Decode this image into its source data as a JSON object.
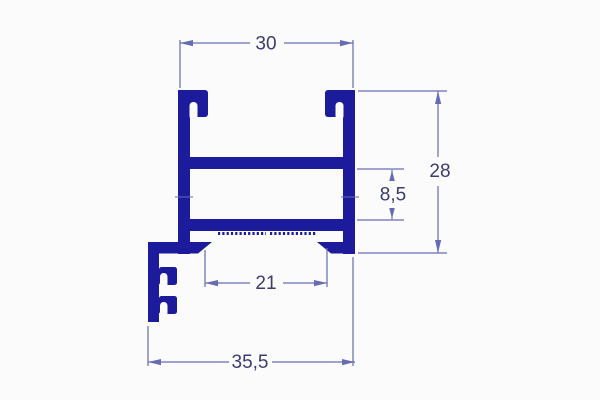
{
  "colors": {
    "background": "#fbfbfc",
    "profile": "#1b1b9b",
    "dimension_line": "#686bb2",
    "dimension_text": "#3c3c72"
  },
  "dimensions": {
    "top_width": "30",
    "overall_height": "28",
    "web_gap": "8,5",
    "bottom_opening": "21",
    "overall_width": "35,5"
  }
}
